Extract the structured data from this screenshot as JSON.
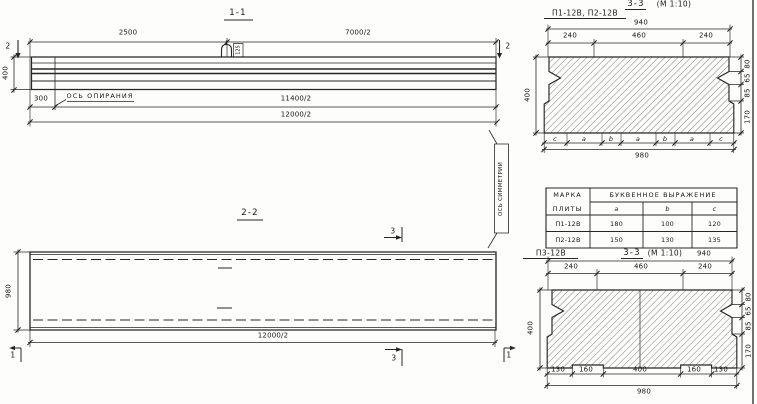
{
  "s11": {
    "title": "1-1",
    "marker": "2",
    "dim_left_span": "2500",
    "dim_right_span": "7000/2",
    "dim_height": "400",
    "dim_overhang": "300",
    "support_axis_label": "ОСЬ ОПИРАНИЯ",
    "loop_tag": "125",
    "dim_support_span": "11400/2",
    "dim_full_span": "12000/2"
  },
  "symmetry": {
    "label": "ОСЬ СИММЕТРИИ"
  },
  "s22": {
    "title": "2-2",
    "marker_3": "3",
    "marker_1": "1",
    "dim_width": "980",
    "dim_full_span": "12000/2"
  },
  "s3top": {
    "label": "П1-12В, П2-12В",
    "title": "3-3",
    "scale": "(М 1:10)",
    "dim_940": "940",
    "dims_top": [
      "240",
      "460",
      "240"
    ],
    "dim_400": "400",
    "dims_right": [
      "80",
      "65",
      "85",
      "170"
    ],
    "letters": [
      "c",
      "a",
      "b",
      "a",
      "b",
      "a",
      "c"
    ],
    "dim_980": "980"
  },
  "table": {
    "header_mark_line1": "МАРКА",
    "header_mark_line2": "ПЛИТЫ",
    "header_expr": "БУКВЕННОЕ ВЫРАЖЕНИЕ",
    "cols": [
      "a",
      "b",
      "c"
    ],
    "rows": [
      {
        "mark": "П1-12В",
        "a": "180",
        "b": "100",
        "c": "120"
      },
      {
        "mark": "П2-12В",
        "a": "150",
        "b": "130",
        "c": "135"
      }
    ]
  },
  "s3bot": {
    "label": "П3-12В",
    "title": "3-3",
    "scale": "(М 1:10)",
    "dim_940": "940",
    "dims_top": [
      "240",
      "460",
      "240"
    ],
    "dim_400": "400",
    "dims_right": [
      "80",
      "65",
      "85",
      "170"
    ],
    "dims_bottom": [
      "130",
      "160",
      "400",
      "160",
      "130"
    ],
    "dim_980": "980"
  }
}
